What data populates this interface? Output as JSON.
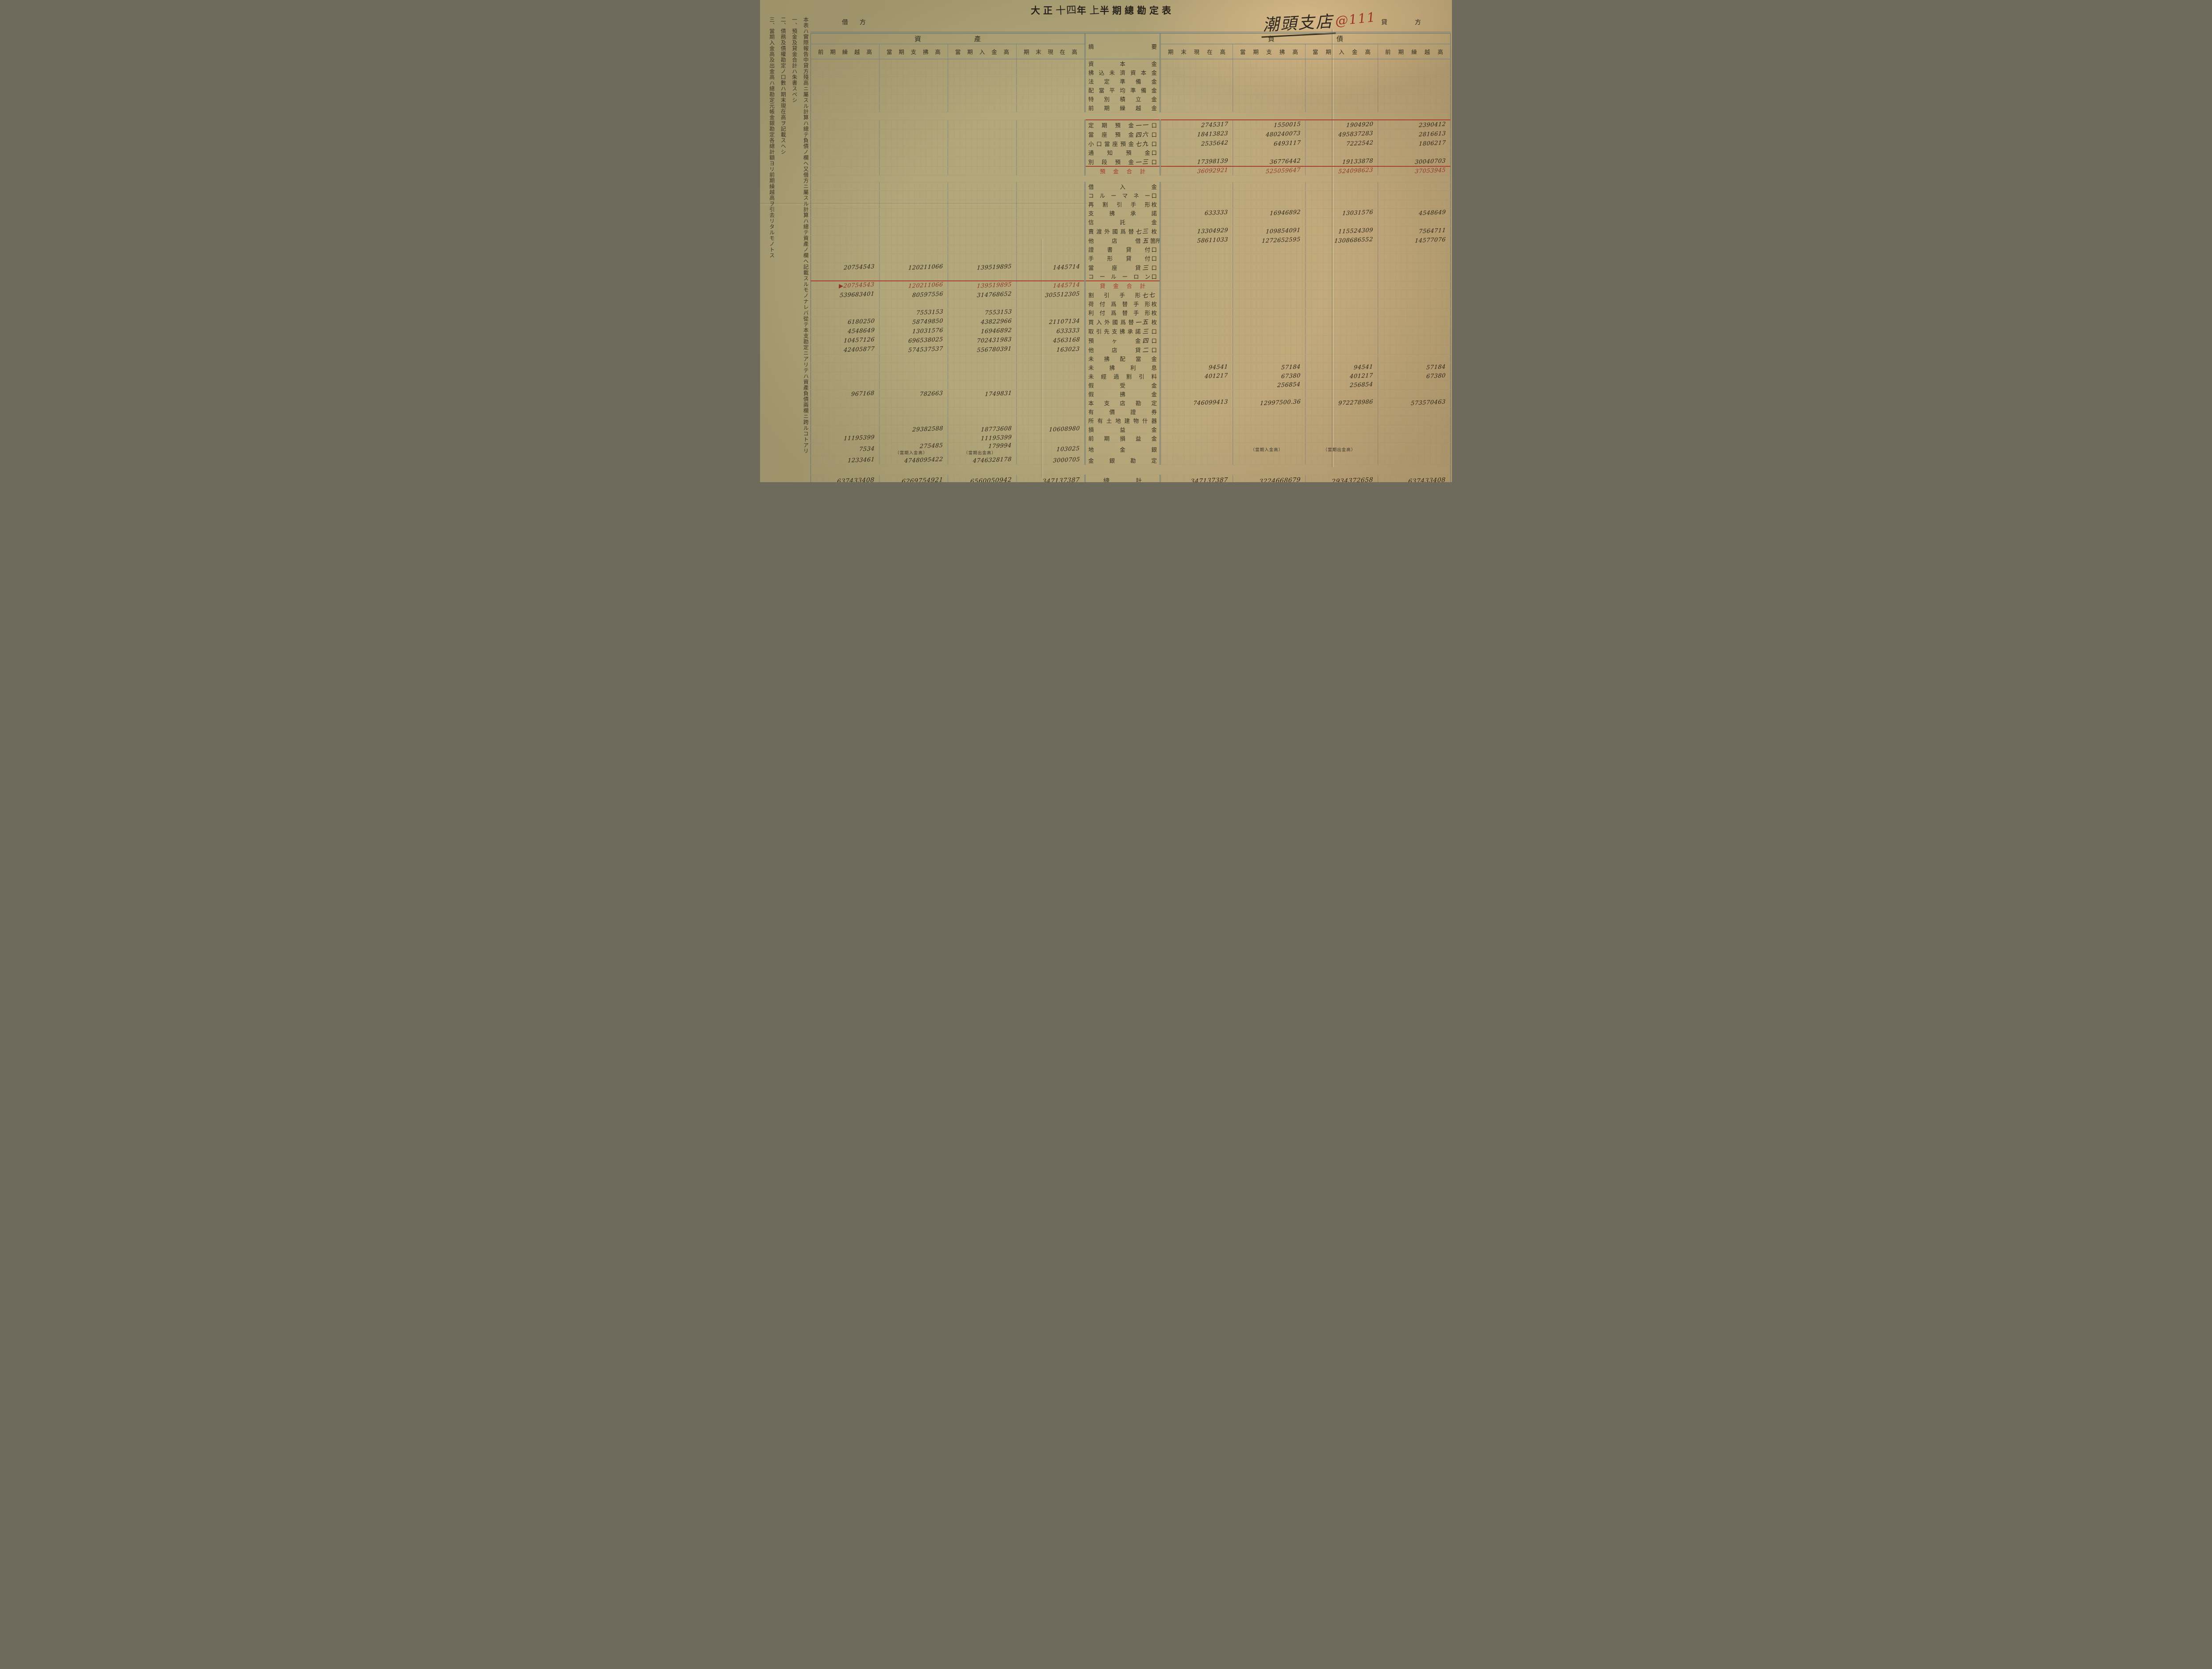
{
  "page": {
    "title_parts": [
      {
        "t": "大正",
        "hw": false
      },
      {
        "t": "十四",
        "hw": true
      },
      {
        "t": "年",
        "hw": false
      },
      {
        "t": "上",
        "hw": true
      },
      {
        "t": "半期總勘定表",
        "hw": false
      }
    ],
    "debit_label_1": "借",
    "debit_label_2": "方",
    "credit_label_1": "貸",
    "credit_label_2": "方",
    "branch_name": "潮頭支店",
    "stamp": "@111"
  },
  "notes": {
    "items": [
      "本表ハ實際報告中貸方殘高ニ屬スル計算ハ總テ負債ノ欄ヘ又借方ニ屬スル計算ハ總テ資產ノ欄ヘ記載スルモノナレバ從テ本支勘定ニアリテハ資產負債兩欄ニ跨ルコトアリ",
      "一、預金及貸金合計ハ朱書スベシ",
      "二、債務及債權勘定ノ口數ハ期末現在高ヲ記載スヘシ",
      "三、當期入金高及出金高ハ總勘定元帳金銀勘定各總計額ヨリ前期繰越高ヲ引去リタルモノトス"
    ]
  },
  "colors": {
    "paper": "#b7aa7d",
    "red_print": "#a23b2b",
    "red_ink": "#8d3426",
    "black_ink": "#2b2418",
    "grid_blue": "#5c7478",
    "grid_red": "#c65c46"
  },
  "table": {
    "section_headers": {
      "assets": "資產",
      "summary": "摘要",
      "liabilities": "負債"
    },
    "asset_columns": [
      "前期繰越高",
      "當期支拂高",
      "當期入金高",
      "期末現在高"
    ],
    "liability_columns": [
      "期末現在高",
      "當期支拂高",
      "當期入金高",
      "前期繰越高"
    ],
    "rows": [
      {
        "label": "資本金"
      },
      {
        "label": "拂込未濟資本金"
      },
      {
        "label": "法定準備金"
      },
      {
        "label": "配當平均準備金"
      },
      {
        "label": "特別積立金"
      },
      {
        "label": "前期繰越金"
      },
      {
        "style": "spacer",
        "h": 16
      },
      {
        "label": "定期預金",
        "count": "一一",
        "unit": "口",
        "right": [
          "2745317",
          "1550015",
          "1904920",
          "2390412"
        ],
        "line": "right"
      },
      {
        "label": "當座預金",
        "count": "四六",
        "unit": "口",
        "right": [
          "18413823",
          "480240073",
          "495837283",
          "2816613"
        ]
      },
      {
        "label": "小口當座預金",
        "count": "七九",
        "unit": "口",
        "right": [
          "2535642",
          "6493117",
          "7222542",
          "1806217"
        ]
      },
      {
        "label": "通知預金",
        "unit": "口"
      },
      {
        "label": "別段預金",
        "count": "一三",
        "unit": "口",
        "right": [
          "17398139",
          "36776442",
          "19133878",
          "30040703"
        ]
      },
      {
        "label": "預金合計",
        "style": "red-right",
        "right": [
          "36092921",
          "525059647",
          "524098623",
          "37053945"
        ],
        "line": "right"
      },
      {
        "style": "spacer",
        "h": 14
      },
      {
        "label": "借入金"
      },
      {
        "label": "コルーマネー",
        "unit": "口"
      },
      {
        "label": "再割引手形",
        "unit": "枚"
      },
      {
        "label": "支拂承諾",
        "right": [
          "633333",
          "16946892",
          "13031576",
          "4548649"
        ]
      },
      {
        "label": "信託金"
      },
      {
        "label": "賣渡外國爲替",
        "count": "七三",
        "unit": "枚",
        "right": [
          "13304929",
          "109854091",
          "115524309",
          "7564711"
        ]
      },
      {
        "label": "他店借",
        "count": "五",
        "unit": "箇所",
        "right": [
          "58611033",
          "1272652595",
          "1308686552",
          "14577076"
        ]
      },
      {
        "label": "證書貸付",
        "unit": "口"
      },
      {
        "label": "手形貸付",
        "unit": "口"
      },
      {
        "label": "當座貸",
        "count": "三",
        "unit": "口",
        "left": [
          "20754543",
          "120211066",
          "139519895",
          "1445714"
        ]
      },
      {
        "label": "コールーロン",
        "unit": "口"
      },
      {
        "label": "貸金合計",
        "style": "red-left",
        "left": [
          "▶20754543",
          "120211066",
          "139519895",
          "1445714"
        ],
        "line": "left"
      },
      {
        "label": "割引手形",
        "count": "七七",
        "left": [
          "539683401",
          "80597556",
          "314768652",
          "305512305"
        ]
      },
      {
        "label": "荷付爲替手形",
        "unit": "枚"
      },
      {
        "label": "利付爲替手形",
        "unit": "枚",
        "left": [
          "",
          "7553153",
          "7553153",
          ""
        ]
      },
      {
        "label": "買入外國爲替",
        "count": "一五",
        "unit": "枚",
        "left": [
          "6180250",
          "58749850",
          "43822966",
          "21107134"
        ]
      },
      {
        "label": "取引先支拂承諾",
        "count": "三",
        "unit": "口",
        "left": [
          "4548649",
          "13031576",
          "16946892",
          "633333"
        ]
      },
      {
        "label": "預ヶ金",
        "count": "四",
        "unit": "口",
        "left": [
          "10457126",
          "696538025",
          "702431983",
          "4563168"
        ]
      },
      {
        "label": "他店貸",
        "count": "二",
        "unit": "口",
        "left": [
          "42405877",
          "574537537",
          "556780391",
          "163023"
        ]
      },
      {
        "label": "未拂配當金"
      },
      {
        "label": "未拂利息",
        "right": [
          "94541",
          "57184",
          "94541",
          "57184"
        ]
      },
      {
        "label": "未經過割引料",
        "right": [
          "401217",
          "67380",
          "401217",
          "67380"
        ]
      },
      {
        "label": "假受金",
        "right": [
          "",
          "256854",
          "256854",
          ""
        ]
      },
      {
        "label": "假拂金",
        "left": [
          "967168",
          "782663",
          "1749831",
          ""
        ]
      },
      {
        "label": "本支店勘定",
        "right": [
          "746099413",
          "12997500.36",
          "972278986",
          "573570463"
        ]
      },
      {
        "label": "有價證券"
      },
      {
        "label": "所有土地建物什器"
      },
      {
        "label": "損益金",
        "left": [
          "",
          "29382588",
          "18773608",
          "10608980"
        ]
      },
      {
        "label": "前期損益金",
        "left": [
          "11195399",
          "",
          "11195399",
          ""
        ]
      },
      {
        "label": "地金銀",
        "h": 30,
        "left": [
          "7534",
          "275485",
          "179994",
          "103025"
        ],
        "sub": [
          "",
          "（當期入金高）",
          "（當期出金高）",
          ""
        ]
      },
      {
        "label": "金銀勘定",
        "left": [
          "1233461",
          "4748095422",
          "4746328178",
          "3000705"
        ]
      },
      {
        "style": "spacer",
        "h": 22
      },
      {
        "label": "總計",
        "style": "grand",
        "left": [
          "637433408",
          "6269754921",
          "6560050942",
          "347137387"
        ],
        "right": [
          "347137387",
          "3224668679",
          "2934372658",
          "637433408"
        ]
      }
    ]
  }
}
